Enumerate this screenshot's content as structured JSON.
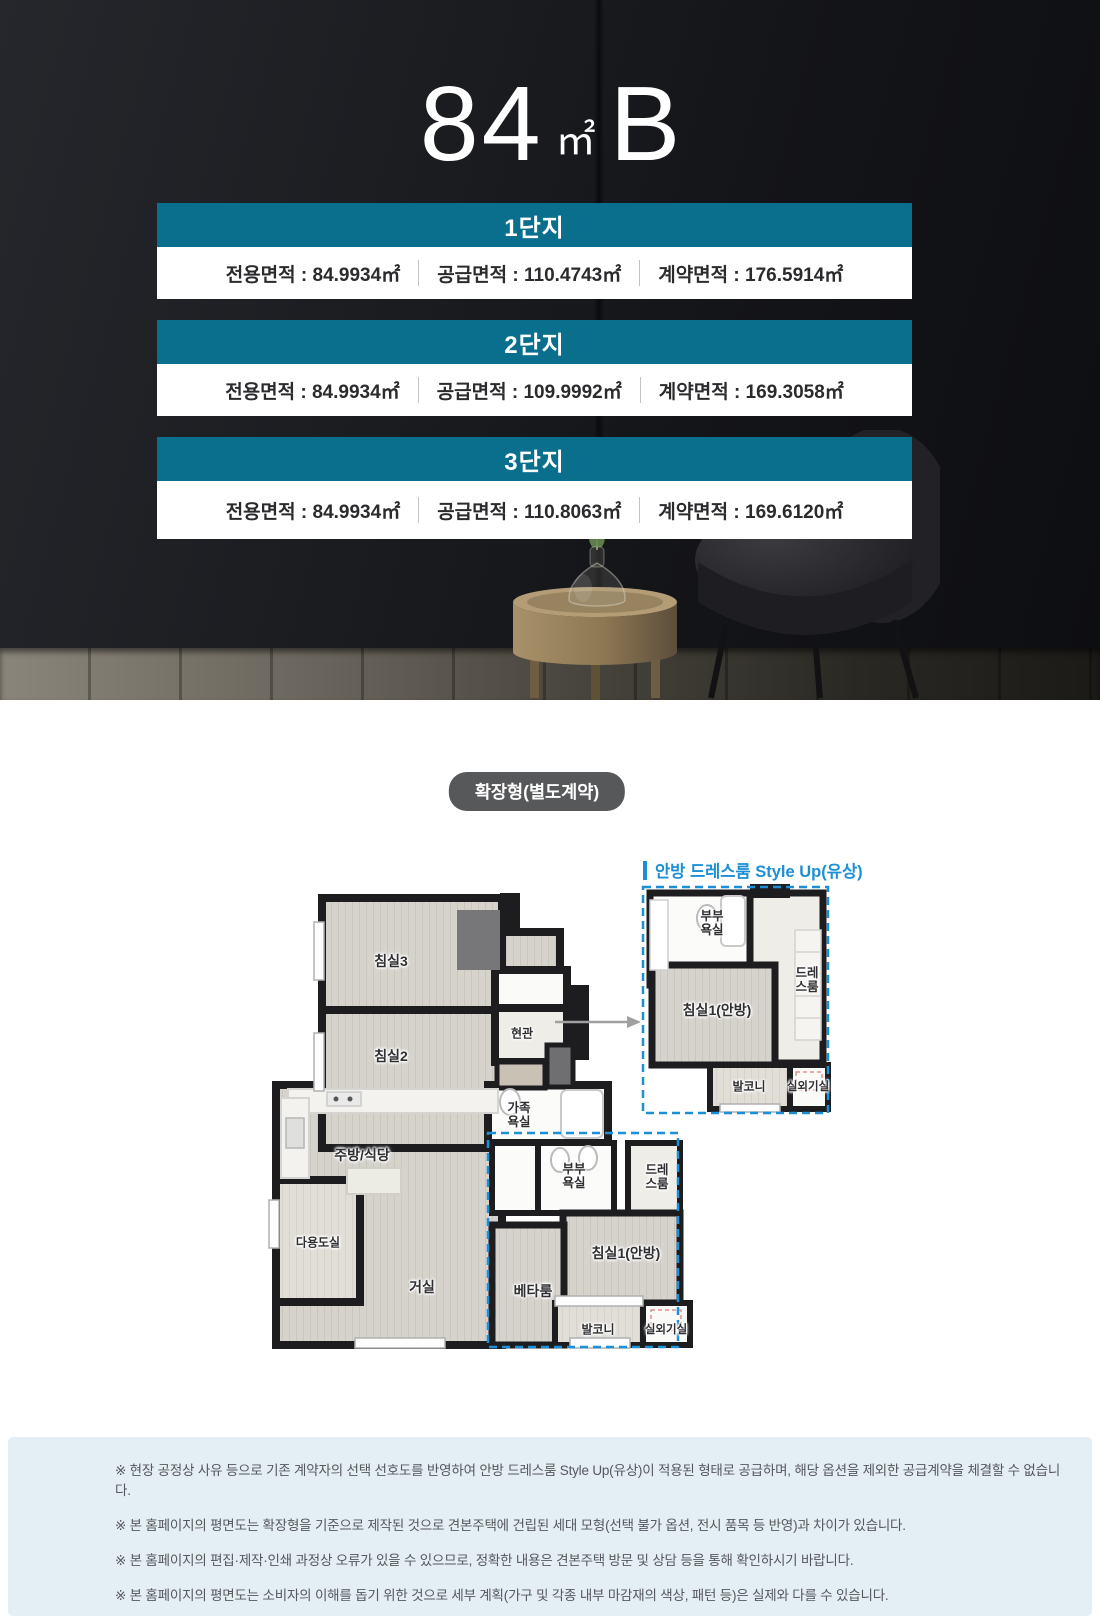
{
  "title": {
    "number": "84",
    "unit": "㎡",
    "variant": "B"
  },
  "complexes": [
    {
      "name": "1단지",
      "areas": [
        "전용면적 : 84.9934㎡",
        "공급면적 : 110.4743㎡",
        "계약면적 : 176.5914㎡"
      ]
    },
    {
      "name": "2단지",
      "areas": [
        "전용면적 : 84.9934㎡",
        "공급면적 : 109.9992㎡",
        "계약면적 : 169.3058㎡"
      ]
    },
    {
      "name": "3단지",
      "areas": [
        "전용면적 : 84.9934㎡",
        "공급면적 : 110.8063㎡",
        "계약면적 : 169.6120㎡"
      ]
    }
  ],
  "plan_section": {
    "badge": "확장형(별도계약)",
    "styleup_label": "안방 드레스룸 Style Up(유상)",
    "main_rooms": [
      "침실3",
      "침실2",
      "현관",
      "가족욕실",
      "주방/식당",
      "다용도실",
      "거실",
      "부부욕실",
      "드레스룸",
      "침실1(안방)",
      "베타룸",
      "발코니",
      "실외기실"
    ],
    "inset_rooms": [
      "부부욕실",
      "드레스룸",
      "침실1(안방)",
      "발코니",
      "실외기실"
    ]
  },
  "notices": [
    "※ 현장 공정상 사유 등으로 기존 계약자의 선택 선호도를 반영하여 안방 드레스룸 Style Up(유상)이 적용된 형태로 공급하며, 해당 옵션을 제외한 공급계약을 체결할 수 없습니다.",
    "※ 본 홈페이지의 평면도는 확장형을 기준으로 제작된 것으로 견본주택에 건립된 세대 모형(선택 불가 옵션, 전시 품목 등 반영)과 차이가 있습니다.",
    "※ 본 홈페이지의 편집·제작·인쇄 과정상 오류가 있을 수 있으므로, 정확한 내용은 견본주택 방문 및 상담 등을 통해 확인하시기 바랍니다.",
    "※ 본 홈페이지의 평면도는 소비자의 이해를 돕기 위한 것으로 세부 계획(가구 및 각종 내부 마감재의 색상, 패턴 등)은 실제와 다를 수 있습니다.",
    "※ 본 홈페이지에 명기된 면적의 소수점 이하 숫자는 실제 시공 시 일부 변경될 수 있으며, 견본주택과 달리 평면이 좌우 반전될 수 있습니다."
  ],
  "colors": {
    "teal": "#0a6e8d",
    "accent_blue": "#1d8fd6",
    "badge_bg": "#57585a",
    "notice_bg": "#e4eef5"
  }
}
